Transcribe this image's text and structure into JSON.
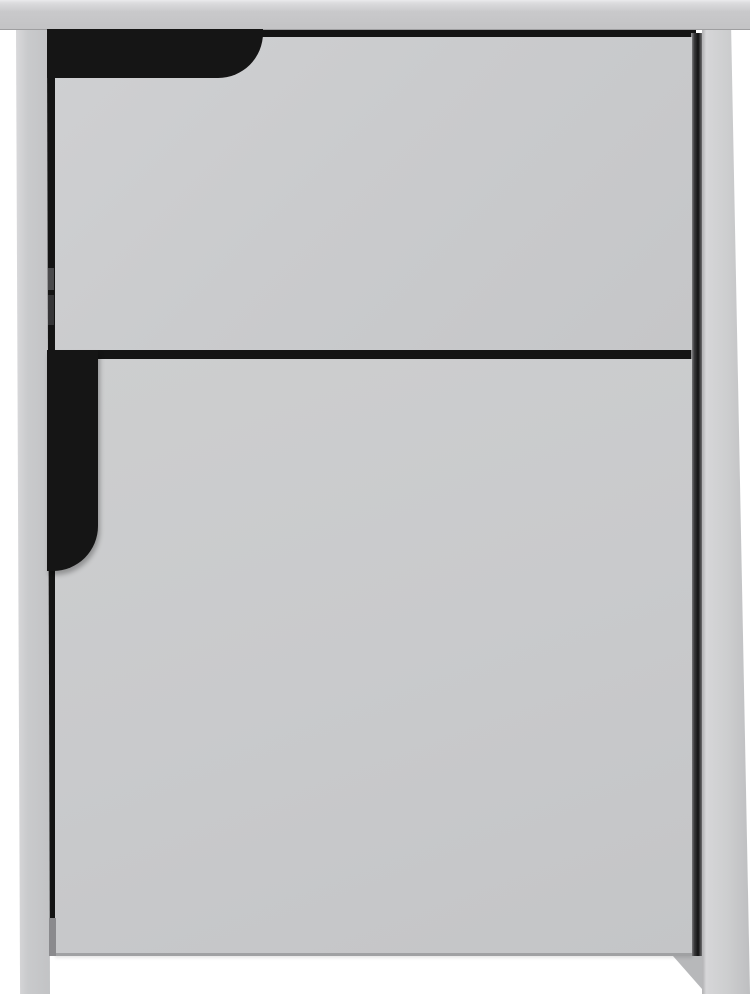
{
  "image": {
    "type": "product-photo",
    "subject": "Grey bedside cabinet with one drawer and one cupboard door, photographed on a plain white background",
    "text_content": "none"
  },
  "colors": {
    "background": "#ffffff",
    "tabletop": "#c9c9cb",
    "front_panel": "#c9cacc",
    "side_panel_left": "#c9cacc",
    "side_panel_right": "#cdcecf",
    "recess_black": "#151515",
    "gap_shadow": "#141414",
    "bottom_edge_shadow": "#a0a1a3",
    "hinge_mark": "#4a4a4c"
  },
  "parts": {
    "tabletop": "Top panel with front edge highlight",
    "drawer": "Drawer front with recessed corner grip cut into its top-left corner",
    "drawer_handle": "Black finger recess with rounded lower-right corner above the drawer",
    "door": "Cupboard door front",
    "door_handle": "Black vertical finger recess with rounded lower-right corner on the door's left edge",
    "left_side": "Left side panel forming the left leg down to the floor",
    "right_side": "Right side panel forming the right leg, seen slightly from the side",
    "right_leg_inner": "Inner face of the right leg visible below the door",
    "gap_top": "Shadow gap between tabletop and drawer",
    "gap_mid": "Shadow gap between drawer and door",
    "gap_left": "Shadow gap between left side panel and fronts",
    "gap_right": "Shadow gap between fronts and right side panel",
    "hinge": "Concealed hinge glimpsed in the left shadow gap"
  }
}
